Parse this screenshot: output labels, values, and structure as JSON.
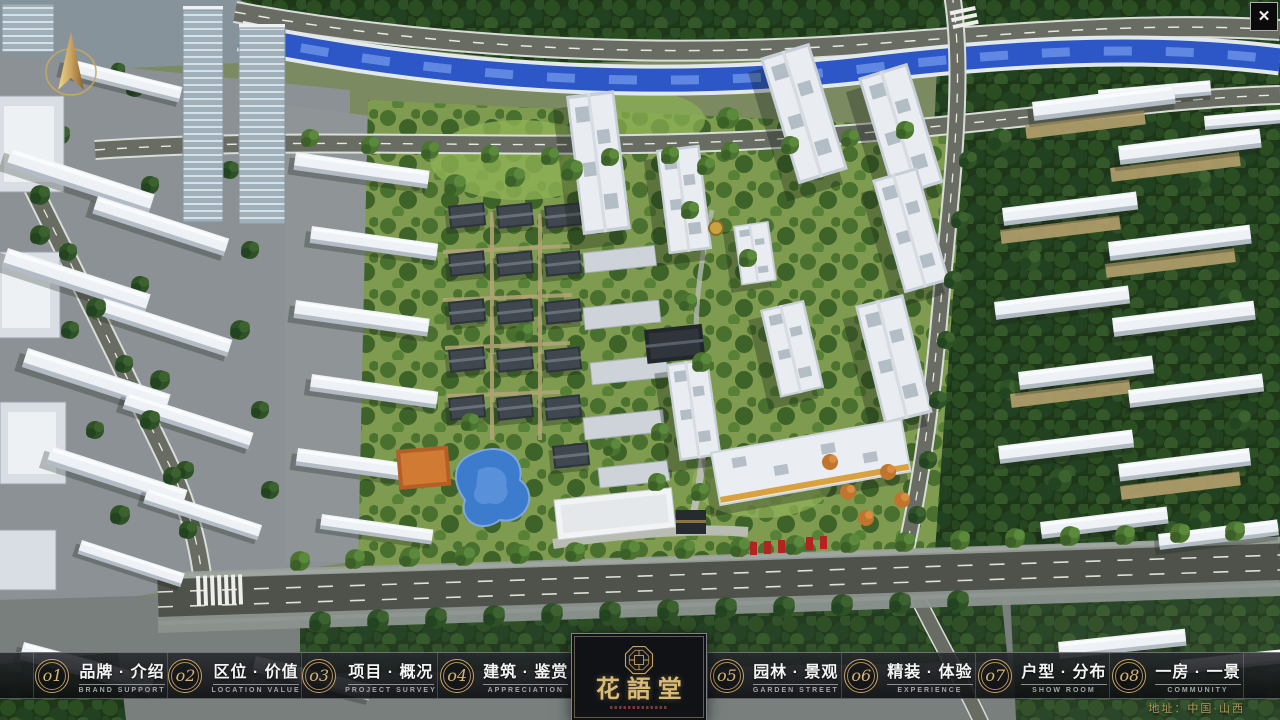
{
  "app": {
    "name": "花語堂",
    "address_label": "地址：中国·山西",
    "theme": {
      "accent_gold": "#c9a469",
      "bar_background": "#14161a",
      "text_primary": "#f5f5f5",
      "text_secondary": "#a6a6a6",
      "river_blue": "#2d57c7",
      "logo_gold": "#d9ba76"
    }
  },
  "logo": {
    "name": "花語堂",
    "emblem_icon": "octagonal-seal-icon"
  },
  "nav": {
    "items": [
      {
        "number": "o1",
        "zh": "品牌 · 介绍",
        "en": "BRAND SUPPORT"
      },
      {
        "number": "o2",
        "zh": "区位 · 价值",
        "en": "LOCATION VALUE"
      },
      {
        "number": "o3",
        "zh": "项目 · 概况",
        "en": "PROJECT SURVEY"
      },
      {
        "number": "o4",
        "zh": "建筑 · 鉴赏",
        "en": "APPRECIATION"
      },
      {
        "number": "o5",
        "zh": "园林 · 景观",
        "en": "GARDEN STREET"
      },
      {
        "number": "o6",
        "zh": "精装 · 体验",
        "en": "EXPERIENCE"
      },
      {
        "number": "o7",
        "zh": "户型 · 分布",
        "en": "SHOW ROOM"
      },
      {
        "number": "o8",
        "zh": "一房 · 一景",
        "en": "COMMUNITY"
      }
    ]
  },
  "controls": {
    "close_glyph": "✕",
    "compass_icon": "north-compass-icon"
  }
}
